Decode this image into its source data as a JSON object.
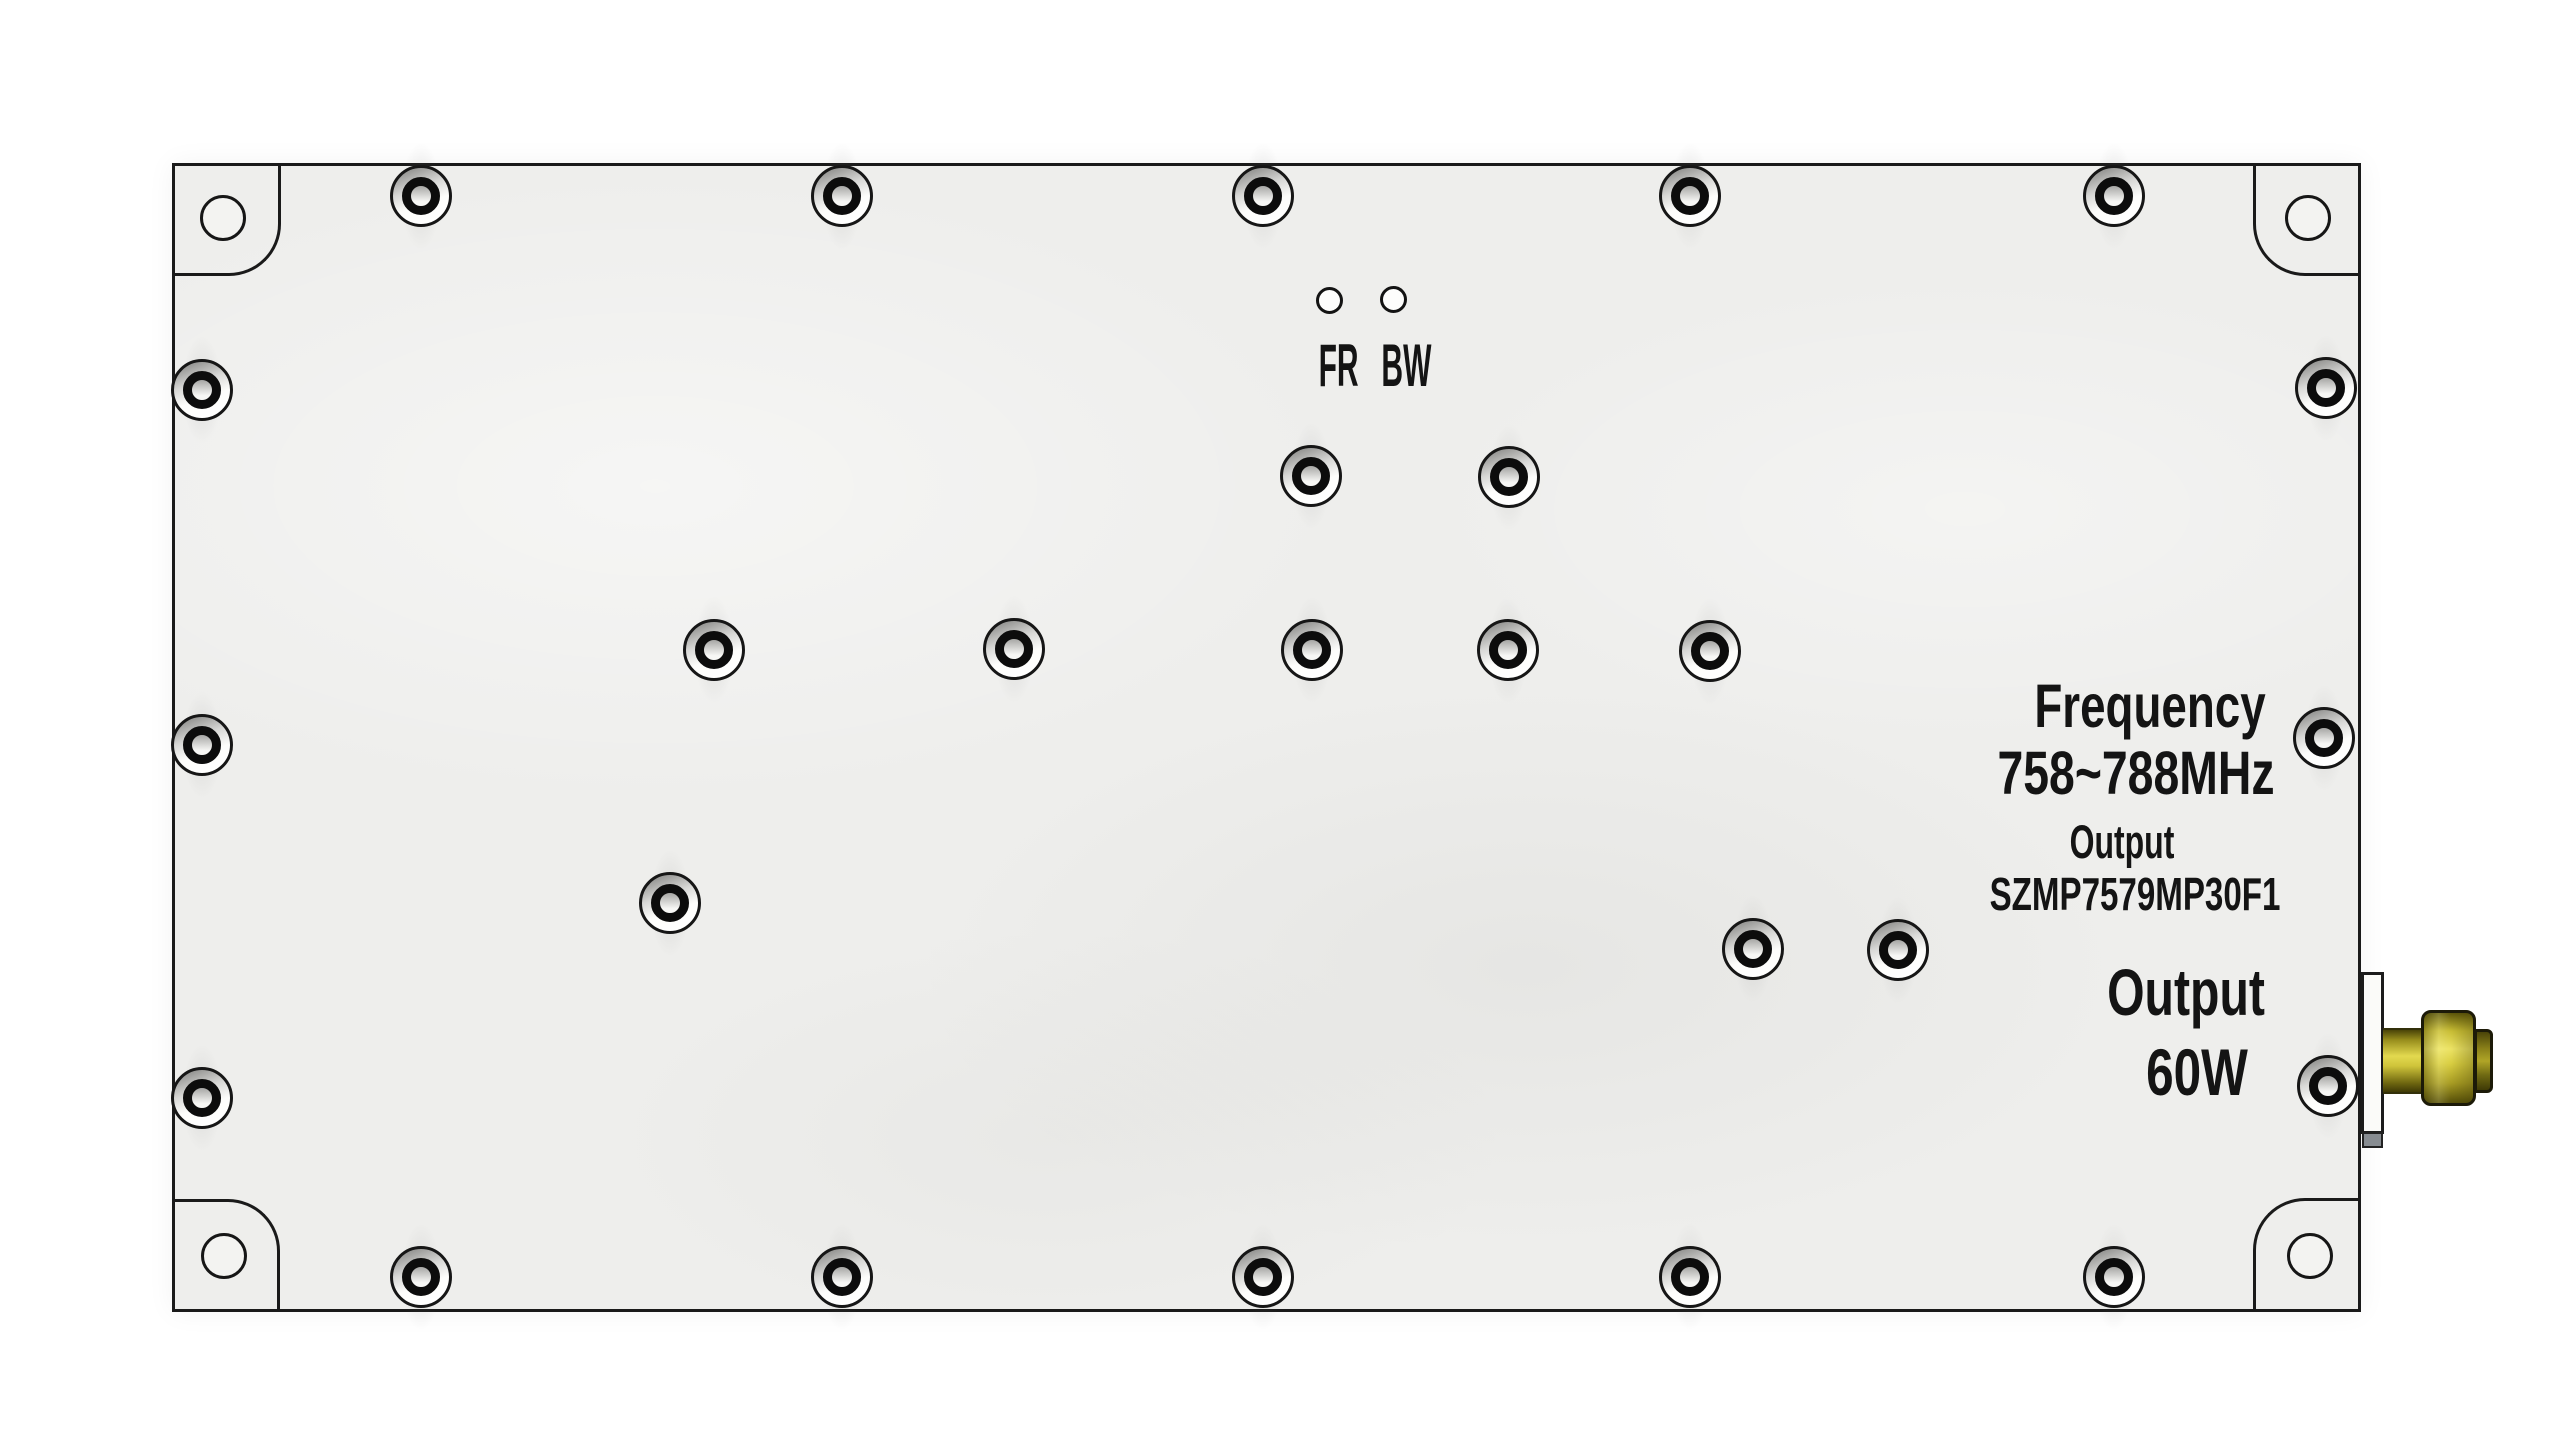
{
  "meta": {
    "description": "Top view of an RF power amplifier module enclosure"
  },
  "labels": {
    "indicator": "FR BW",
    "frequency_title": "Frequency",
    "frequency_range": "758~788MHz",
    "output_caption": "Output",
    "model_number": "SZMP7579MP30F1",
    "output_title": "Output",
    "output_power": "60W"
  },
  "colors": {
    "background": "#ffffff",
    "panel": "#eeeeec",
    "outline": "#1a1a1a",
    "text": "#141414",
    "connector_gold": "#d9ce41",
    "connector_gold_dark": "#57520a",
    "flange_foot": "#878c91"
  },
  "hardware": {
    "screws": [
      {
        "x": 421,
        "y": 196
      },
      {
        "x": 842,
        "y": 196
      },
      {
        "x": 1263,
        "y": 196
      },
      {
        "x": 1690,
        "y": 196
      },
      {
        "x": 2114,
        "y": 196
      },
      {
        "x": 421,
        "y": 1277
      },
      {
        "x": 842,
        "y": 1277
      },
      {
        "x": 1263,
        "y": 1277
      },
      {
        "x": 1690,
        "y": 1277
      },
      {
        "x": 2114,
        "y": 1277
      },
      {
        "x": 202,
        "y": 390
      },
      {
        "x": 202,
        "y": 745
      },
      {
        "x": 202,
        "y": 1098
      },
      {
        "x": 2326,
        "y": 388
      },
      {
        "x": 2324,
        "y": 738
      },
      {
        "x": 2328,
        "y": 1086
      },
      {
        "x": 1311,
        "y": 476
      },
      {
        "x": 1509,
        "y": 477
      },
      {
        "x": 714,
        "y": 650
      },
      {
        "x": 1014,
        "y": 649
      },
      {
        "x": 1312,
        "y": 650
      },
      {
        "x": 1508,
        "y": 650
      },
      {
        "x": 1710,
        "y": 651
      },
      {
        "x": 670,
        "y": 903
      },
      {
        "x": 1753,
        "y": 949
      },
      {
        "x": 1898,
        "y": 950
      }
    ],
    "corner_holes": [
      {
        "x": 223,
        "y": 218
      },
      {
        "x": 2308,
        "y": 218
      },
      {
        "x": 224,
        "y": 1256
      },
      {
        "x": 2310,
        "y": 1256
      }
    ],
    "led_holes": [
      {
        "x": 1329,
        "y": 300
      },
      {
        "x": 1393,
        "y": 299
      }
    ]
  }
}
